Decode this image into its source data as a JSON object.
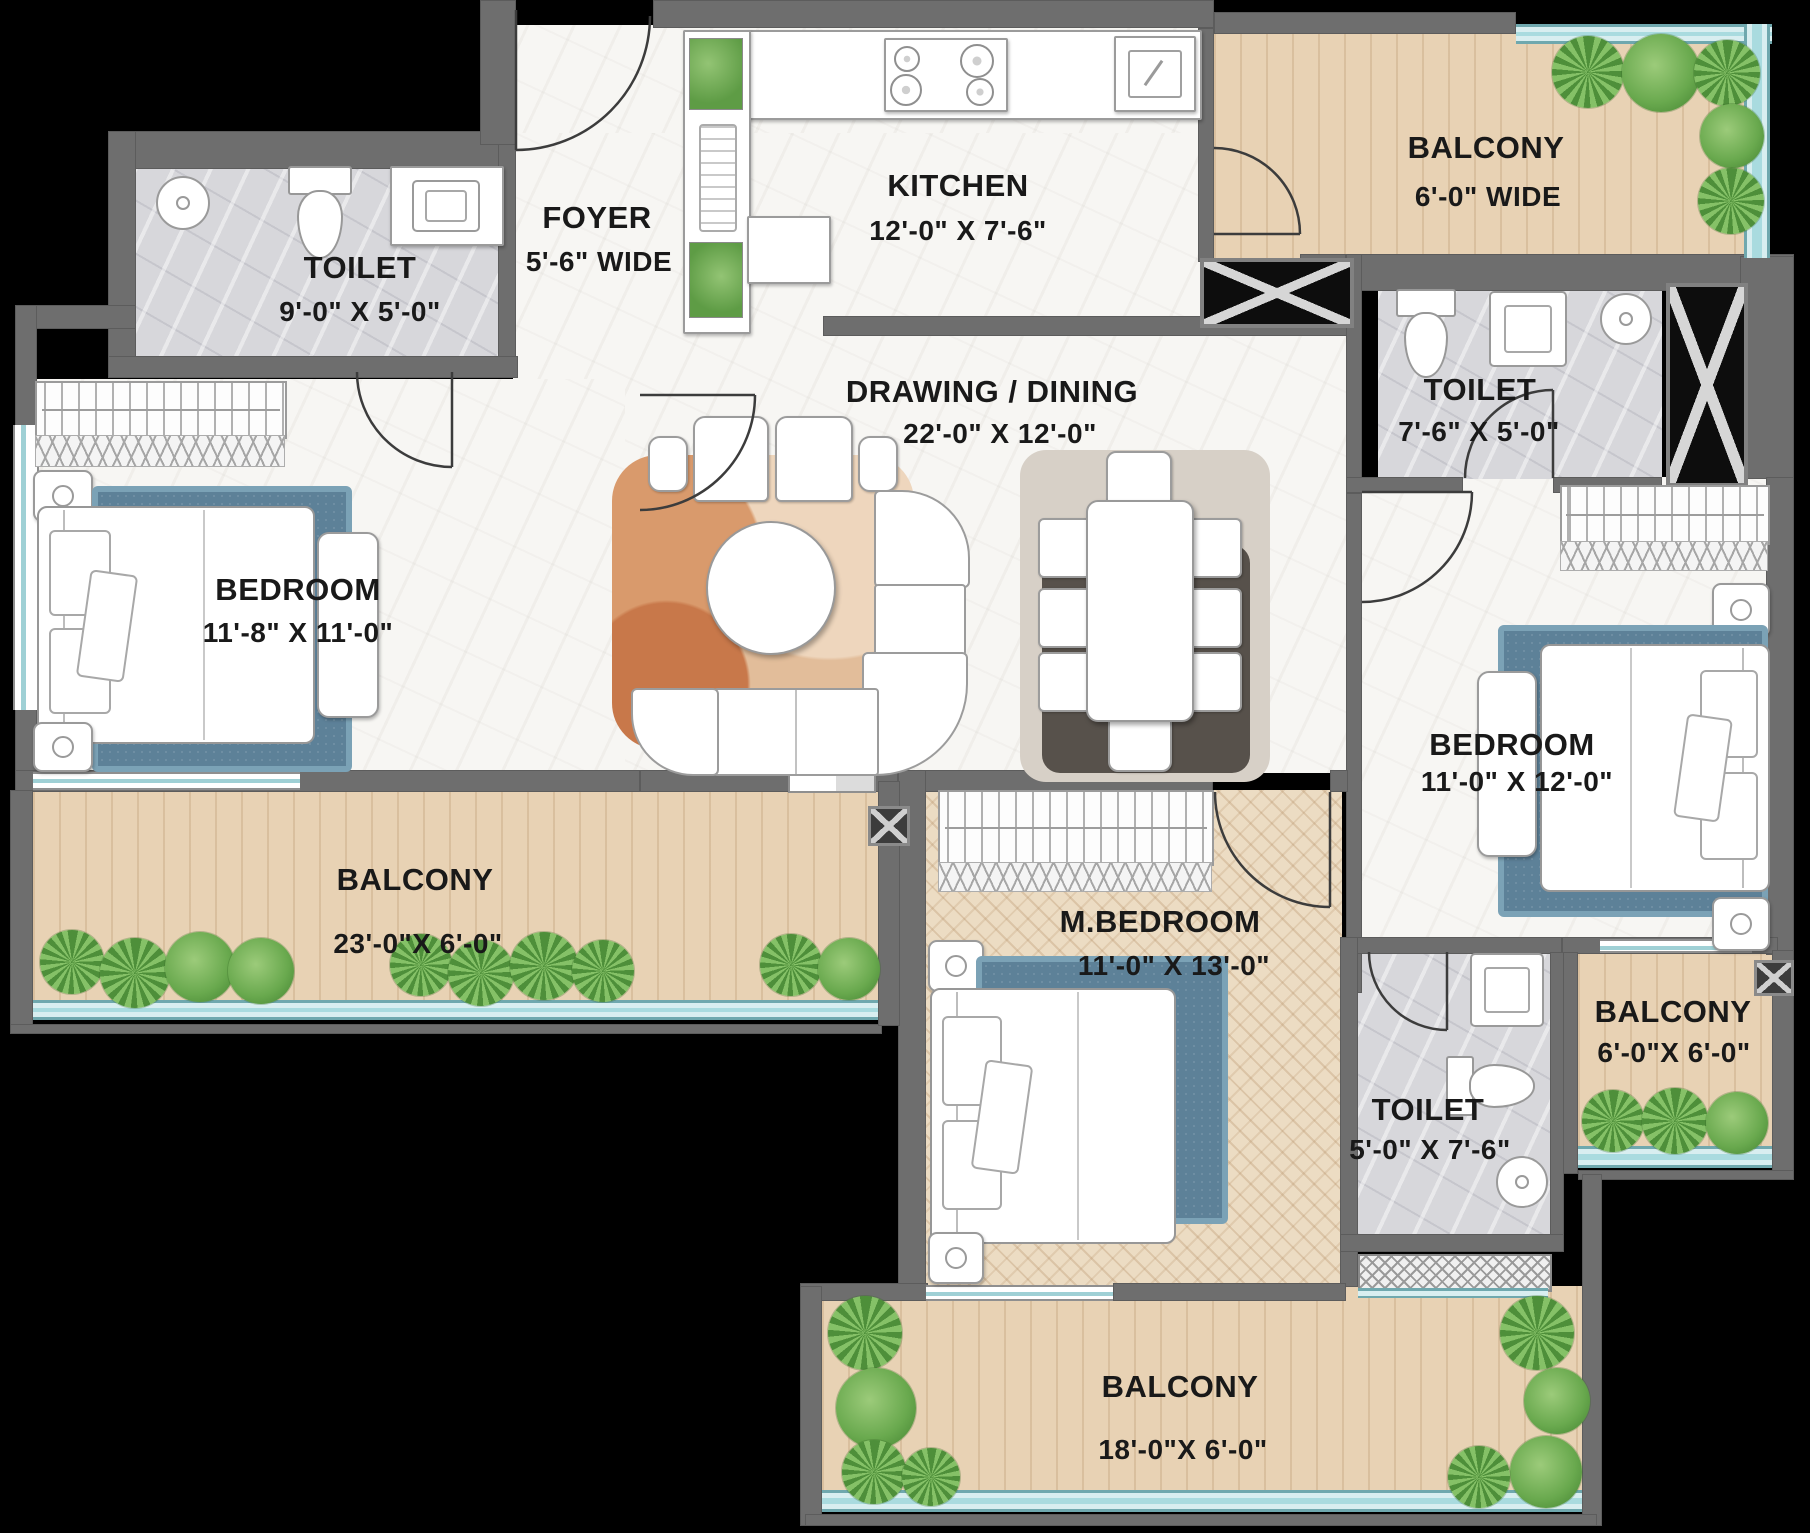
{
  "plan": {
    "type": "apartment-floor-plan",
    "rooms": {
      "toilet1": {
        "name": "TOILET",
        "dims": "9'-0\" X 5'-0\""
      },
      "foyer": {
        "name": "FOYER",
        "dims": "5'-6\" WIDE"
      },
      "kitchen": {
        "name": "KITCHEN",
        "dims": "12'-0\" X 7'-6\""
      },
      "balcony1": {
        "name": "BALCONY",
        "dims": "6'-0\" WIDE"
      },
      "toilet2": {
        "name": "TOILET",
        "dims": "7'-6\" X 5'-0\""
      },
      "drawing": {
        "name": "DRAWING / DINING",
        "dims": "22'-0\" X 12'-0\""
      },
      "bedroom1": {
        "name": "BEDROOM",
        "dims": "11'-8\" X 11'-0\""
      },
      "bedroom2": {
        "name": "BEDROOM",
        "dims": "11'-0\" X 12'-0\""
      },
      "balcony2": {
        "name": "BALCONY",
        "dims": "23'-0\"X 6'-0\""
      },
      "mbedroom": {
        "name": "M.BEDROOM",
        "dims": "11'-0\" X 13'-0\""
      },
      "toilet3": {
        "name": "TOILET",
        "dims": "5'-0\" X 7'-6\""
      },
      "balcony3": {
        "name": "BALCONY",
        "dims": "6'-0\"X 6'-0\""
      },
      "balcony4": {
        "name": "BALCONY",
        "dims": "18'-0\"X 6'-0\""
      }
    },
    "palette": {
      "wall": "#6e6e6e",
      "interior_floor": "#f7f6f3",
      "toilet_tile": "#d7d7db",
      "balcony_wood": "#e8d2b4",
      "railing_teal": "#a9dbdf",
      "rug_blue": "#5d8198",
      "plant_green": "#69a94e",
      "text": "#191919"
    },
    "symbols": [
      "bed-symbol",
      "wardrobe-symbol",
      "sofa-symbol",
      "dining-table-symbol",
      "coffee-table-symbol",
      "wc-symbol",
      "washbasin-symbol",
      "shower-symbol",
      "stove-symbol",
      "kitchen-sink-symbol",
      "plant-symbol",
      "door-arc-symbol",
      "duct-shaft-symbol",
      "window-symbol"
    ]
  }
}
